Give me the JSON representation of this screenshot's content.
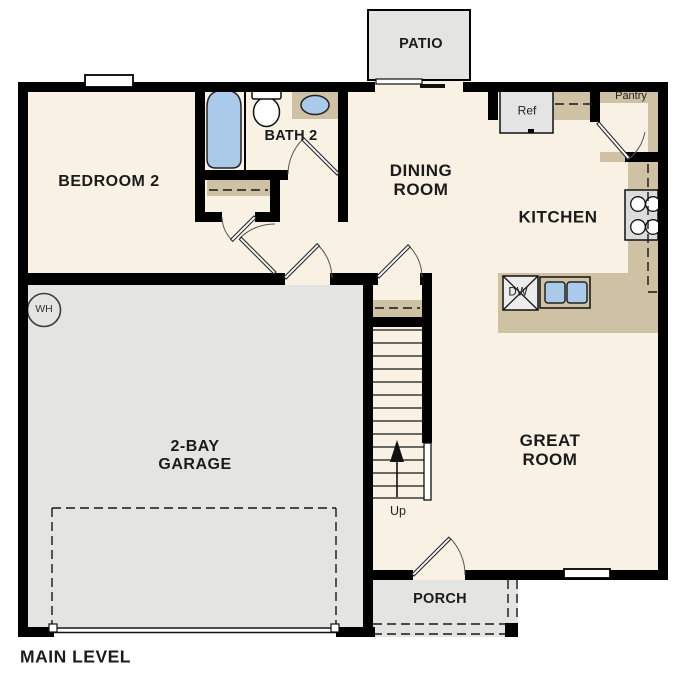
{
  "plan": {
    "title": "MAIN LEVEL",
    "rooms": {
      "patio": "PATIO",
      "bedroom2": "BEDROOM 2",
      "bath2": "BATH 2",
      "dining": "DINING\nROOM",
      "kitchen": "KITCHEN",
      "great": "GREAT\nROOM",
      "garage": "2-BAY\nGARAGE",
      "porch": "PORCH",
      "pantry": "Pantry"
    },
    "fixtures": {
      "ref": "Ref",
      "dw": "DW",
      "wh": "WH",
      "up": "Up"
    }
  },
  "colors": {
    "floor": "#f8f1e4",
    "hard": "#e4e4e2",
    "counter": "#cfc1a4",
    "blue": "#abc9e9",
    "wall": "#000000",
    "appliance": "#e4e4e4",
    "text": "#1b1b1b"
  }
}
